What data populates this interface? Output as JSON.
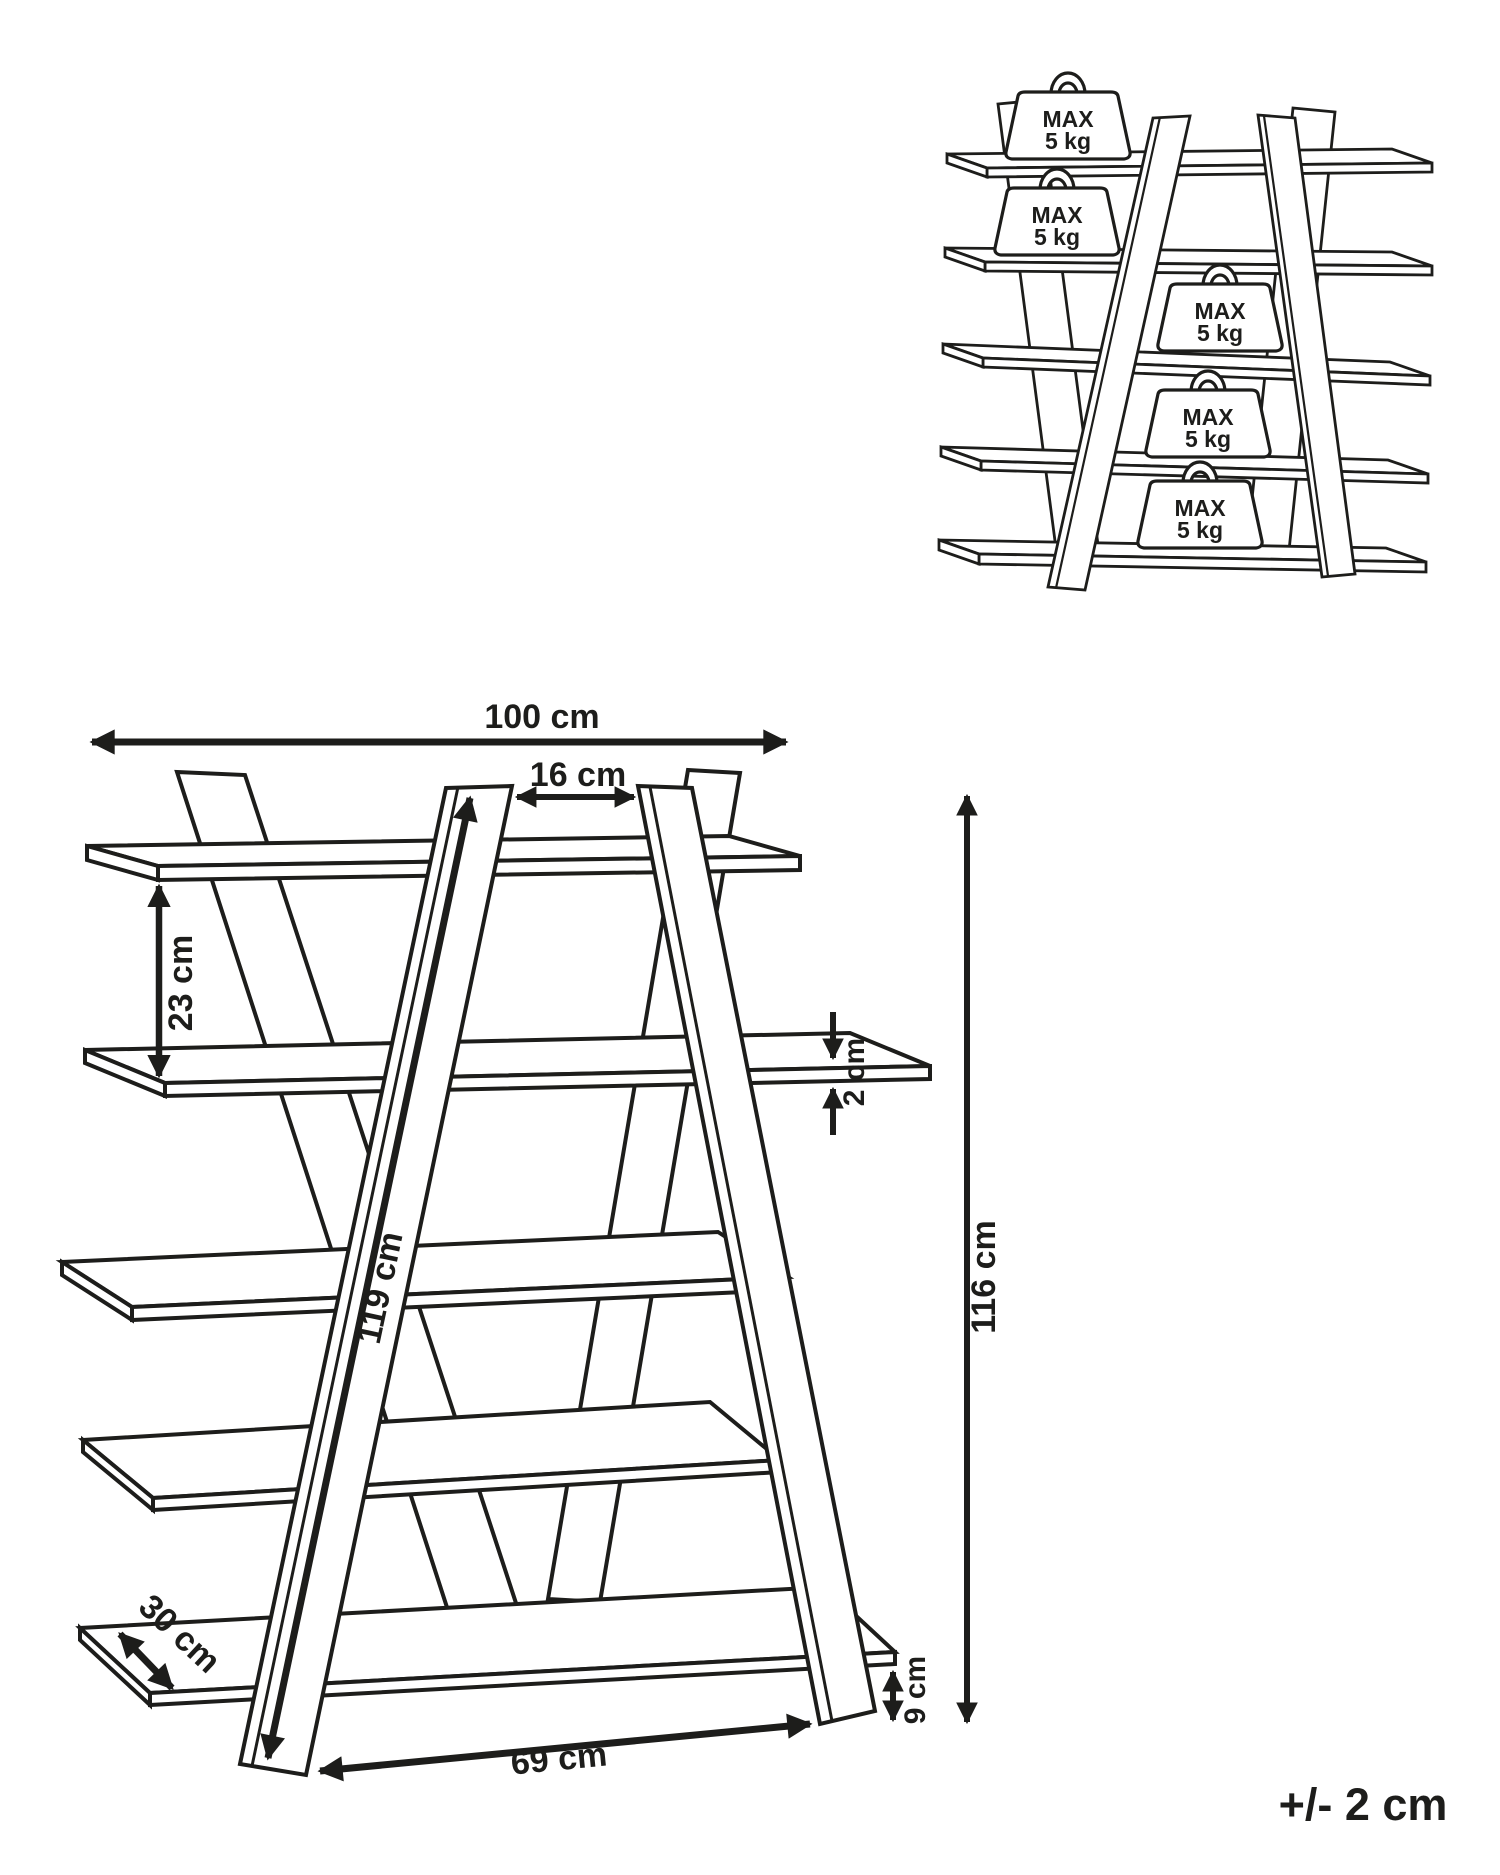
{
  "page": {
    "background_color": "#ffffff",
    "line_color": "#1d1d1b"
  },
  "dimensions": {
    "total_width": "100 cm",
    "top_opening": "16 cm",
    "shelf_spacing": "23 cm",
    "shelf_thickness": "2 cm",
    "leg_length": "119 cm",
    "total_height": "116 cm",
    "shelf_depth": "30 cm",
    "floor_clearance": "9 cm",
    "base_width": "69 cm"
  },
  "tolerance_label": "+/- 2 cm",
  "load_limits": {
    "per_shelf": [
      {
        "line1": "MAX",
        "line2": "5 kg"
      },
      {
        "line1": "MAX",
        "line2": "5 kg"
      },
      {
        "line1": "MAX",
        "line2": "5 kg"
      },
      {
        "line1": "MAX",
        "line2": "5 kg"
      },
      {
        "line1": "MAX",
        "line2": "5 kg"
      }
    ]
  }
}
